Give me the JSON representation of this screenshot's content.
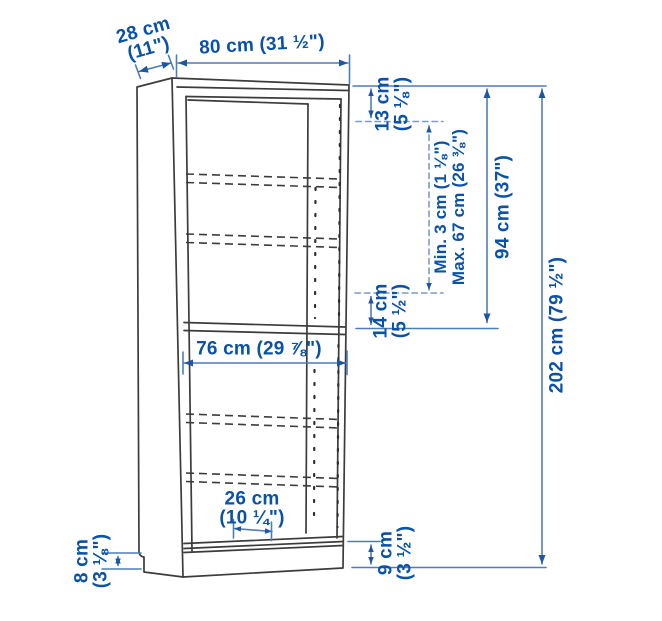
{
  "diagram": {
    "product": "bookcase-dimension-diagram",
    "colors": {
      "dimension_text": "#0a51a8",
      "dimension_line": "#4d7db8",
      "dimension_arrow": "#1e55a5",
      "outline": "#3c3c3c"
    },
    "dims": {
      "depth": {
        "value": "28 cm",
        "imperial": "(11\")"
      },
      "width": {
        "label": "80 cm (31 ½\")"
      },
      "top_gap": {
        "value": "13 cm",
        "imperial": "(5 ⅛\")"
      },
      "shelf_min": {
        "label": "Min. 3 cm (1 ⅛\")"
      },
      "shelf_max": {
        "label": "Max. 67 cm (26 ⅜\")"
      },
      "upper_height": {
        "label": "94 cm (37\")"
      },
      "total_height": {
        "label": "202 cm (79 ½\")"
      },
      "mid_gap": {
        "value": "14 cm",
        "imperial": "(5 ½\")"
      },
      "inner_width": {
        "label": "76 cm (29 ⅞\")"
      },
      "shelf_depth": {
        "value": "26 cm",
        "imperial": "(10 ¼\")"
      },
      "base_left": {
        "value": "8 cm",
        "imperial": "(3 ⅛\")"
      },
      "base_right": {
        "value": "9 cm",
        "imperial": "(3 ½\")"
      }
    }
  }
}
